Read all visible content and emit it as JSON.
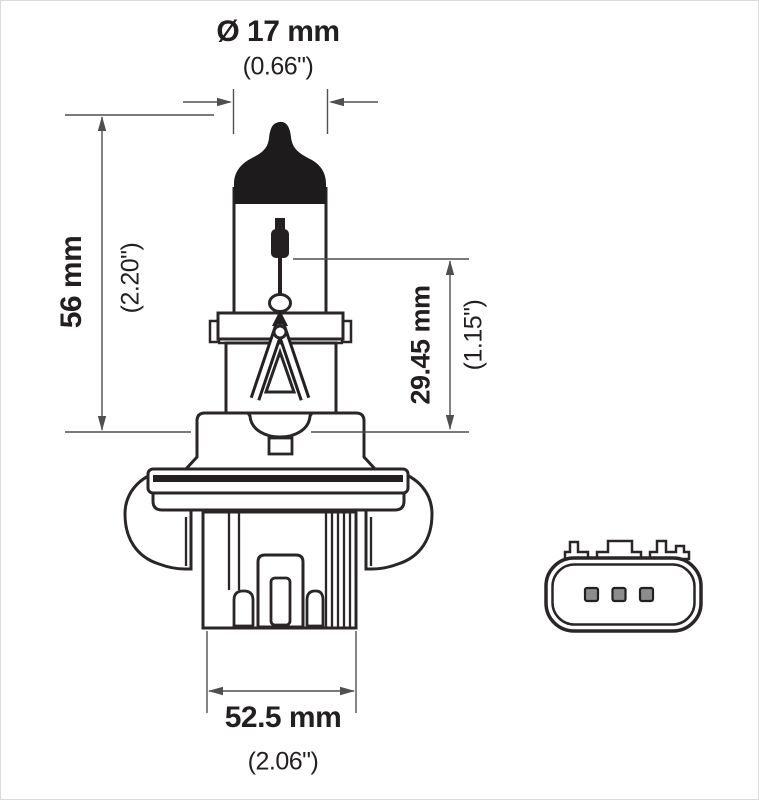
{
  "drawing": {
    "type": "technical-dimension-diagram",
    "subject": "halogen headlight bulb side view with rear connector view",
    "colors": {
      "line": "#2a2627",
      "dome_fill": "#1d1b1c",
      "dimension_line": "#4f4f4f",
      "pin_fill": "#8d8d8d",
      "background": "#ffffff"
    }
  },
  "labels": {
    "diameter_mm": "Ø 17 mm",
    "diameter_in": "(0.66\")",
    "height_mm": "56 mm",
    "height_in": "(2.20\")",
    "depth_mm": "29.45 mm",
    "depth_in": "(1.15\")",
    "width_mm": "52.5 mm",
    "width_in": "(2.06\")"
  }
}
